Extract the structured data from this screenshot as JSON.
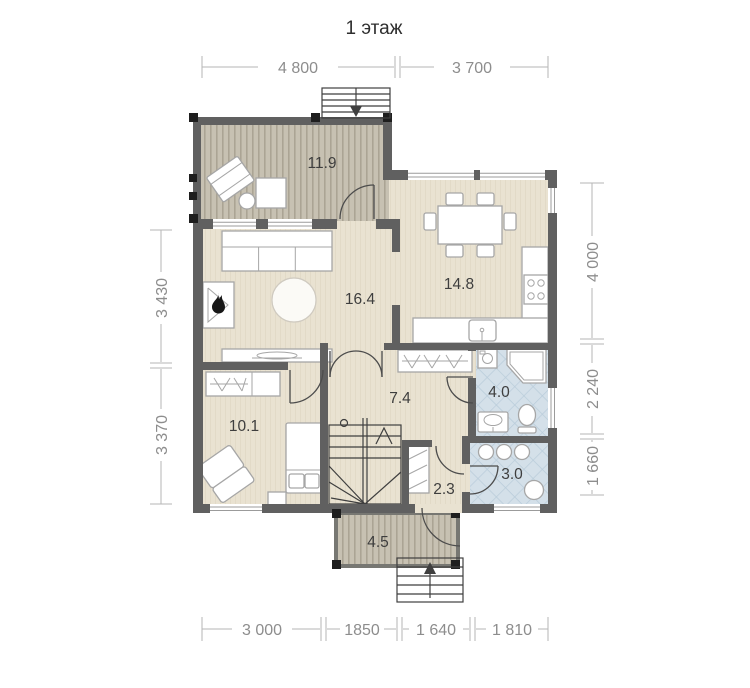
{
  "title": "1 этаж",
  "rooms": {
    "terrace": "11.9",
    "kitchen_dining": "14.8",
    "living": "16.4",
    "bedroom": "10.1",
    "hall": "7.4",
    "bathroom": "4.0",
    "storage": "2.3",
    "shower_room": "3.0",
    "porch": "4.5"
  },
  "dimensions": {
    "top": [
      "4 800",
      "3 700"
    ],
    "bottom": [
      "3 000",
      "1850",
      "1 640",
      "1 810"
    ],
    "left": [
      "3 430",
      "3 370"
    ],
    "right": [
      "4 000",
      "2 240",
      "1 660"
    ]
  },
  "colors": {
    "wall": "#606060",
    "floor": "#e9e2d1",
    "deck": "#c7c1b2",
    "tile": "#d4e0e9",
    "dimension": "#8d8d8d"
  }
}
